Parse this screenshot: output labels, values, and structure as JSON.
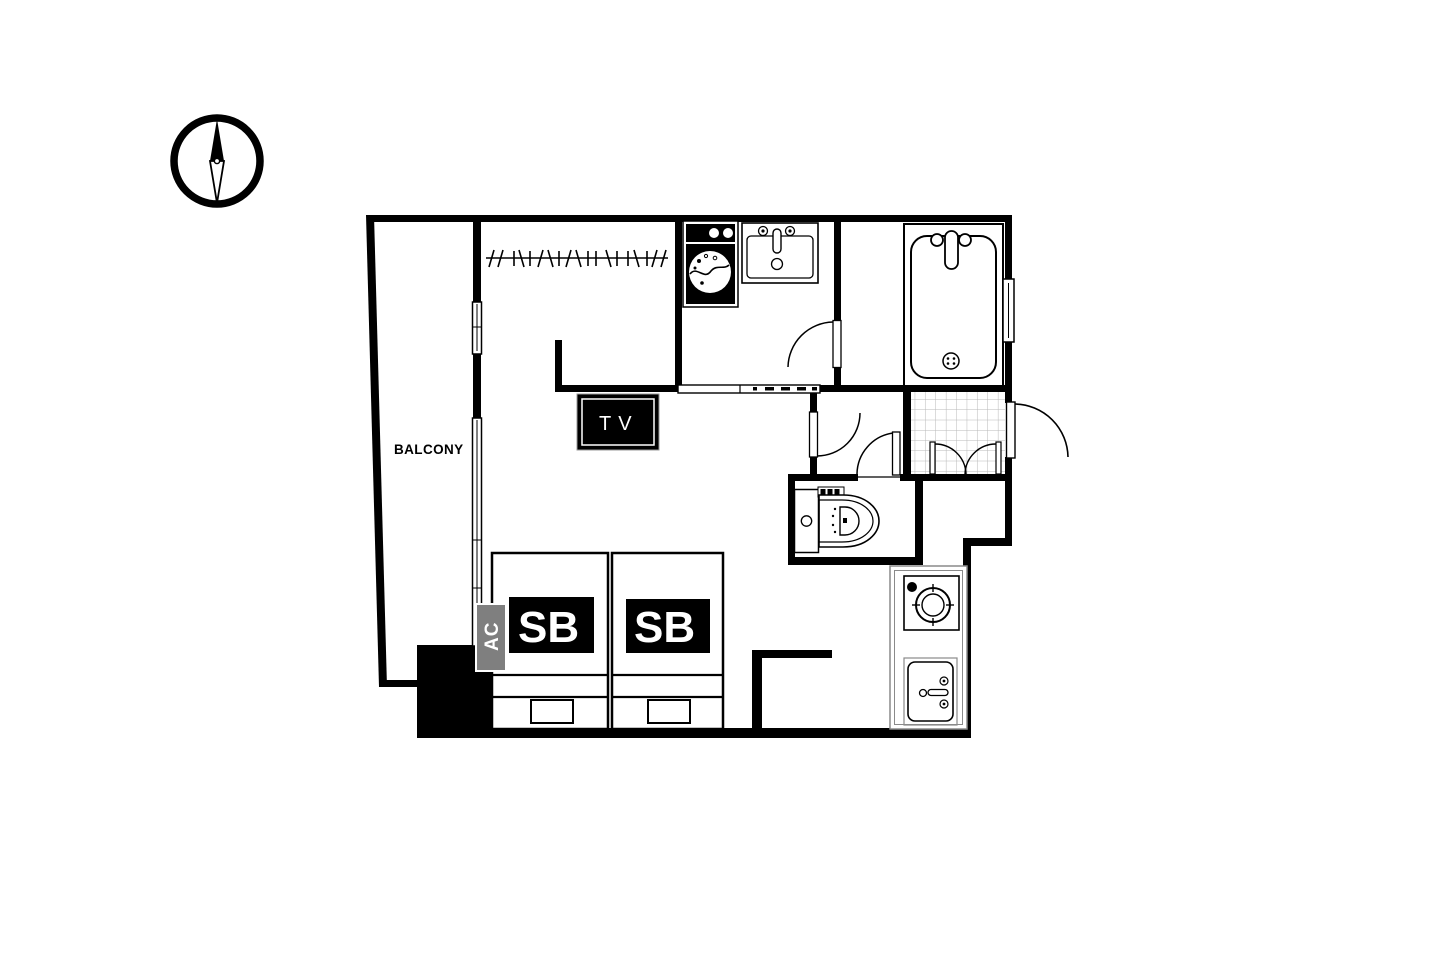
{
  "labels": {
    "balcony": "BALCONY",
    "tv": "TV",
    "bed_1": "SB",
    "bed_2": "SB",
    "ac": "AC"
  },
  "colors": {
    "background": "#ffffff",
    "wall": "#000000",
    "text": "#000000",
    "text_on_dark": "#ffffff",
    "ac_fill": "#7f7f7f",
    "counter_line": "#8a8a8a",
    "tile_line": "#b8b8b8"
  },
  "icons": {
    "compass": "compass-icon",
    "hanger_rod": "hanger-rod-icon",
    "washing_machine": "washing-machine-icon",
    "vanity_sink": "vanity-sink-icon",
    "bathtub": "bathtub-icon",
    "window": "window-icon",
    "sliding_glass_door": "sliding-door-icon",
    "folding_door": "folding-door-icon",
    "door_swing": "door-swing-icon",
    "double_doors": "double-door-icon",
    "entry_tiles": "entry-tiles",
    "toilet": "toilet-icon",
    "tv": "tv-icon",
    "single_bed": "single-bed-icon",
    "ac_unit": "ac-unit-icon",
    "stove_burner": "stove-burner-icon",
    "kitchen_sink": "kitchen-sink-icon",
    "pillar": "structural-pillar"
  }
}
